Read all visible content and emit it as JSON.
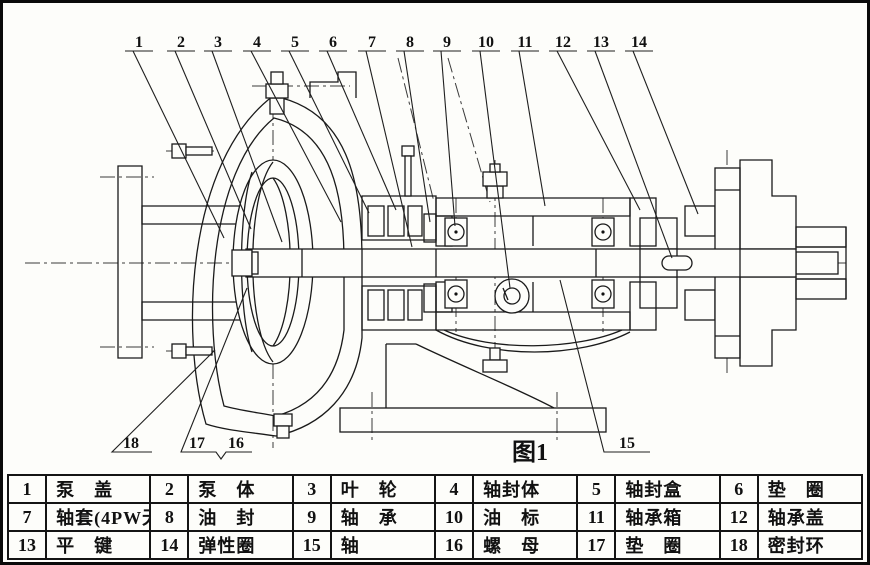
{
  "figure": {
    "caption": "图1"
  },
  "callouts": {
    "top": [
      "1",
      "2",
      "3",
      "4",
      "5",
      "6",
      "7",
      "8",
      "9",
      "10",
      "11",
      "12",
      "13",
      "14"
    ],
    "bottom": [
      "18",
      "17",
      "16",
      "15"
    ]
  },
  "parts_table": {
    "rows": [
      [
        {
          "no": "1",
          "name": "泵　盖"
        },
        {
          "no": "2",
          "name": "泵　体"
        },
        {
          "no": "3",
          "name": "叶　轮"
        },
        {
          "no": "4",
          "name": "轴封体"
        },
        {
          "no": "5",
          "name": "轴封盒"
        },
        {
          "no": "6",
          "name": "垫　圈"
        }
      ],
      [
        {
          "no": "7",
          "name": "轴套(4PW无)"
        },
        {
          "no": "8",
          "name": "油　封"
        },
        {
          "no": "9",
          "name": "轴　承"
        },
        {
          "no": "10",
          "name": "油　标"
        },
        {
          "no": "11",
          "name": "轴承箱"
        },
        {
          "no": "12",
          "name": "轴承盖"
        }
      ],
      [
        {
          "no": "13",
          "name": "平　键"
        },
        {
          "no": "14",
          "name": "弹性圈"
        },
        {
          "no": "15",
          "name": "轴"
        },
        {
          "no": "16",
          "name": "螺　母"
        },
        {
          "no": "17",
          "name": "垫　圈"
        },
        {
          "no": "18",
          "name": "密封环"
        }
      ]
    ]
  },
  "colors": {
    "ink": "#1a1a1a",
    "paper": "#fdfdfa"
  }
}
